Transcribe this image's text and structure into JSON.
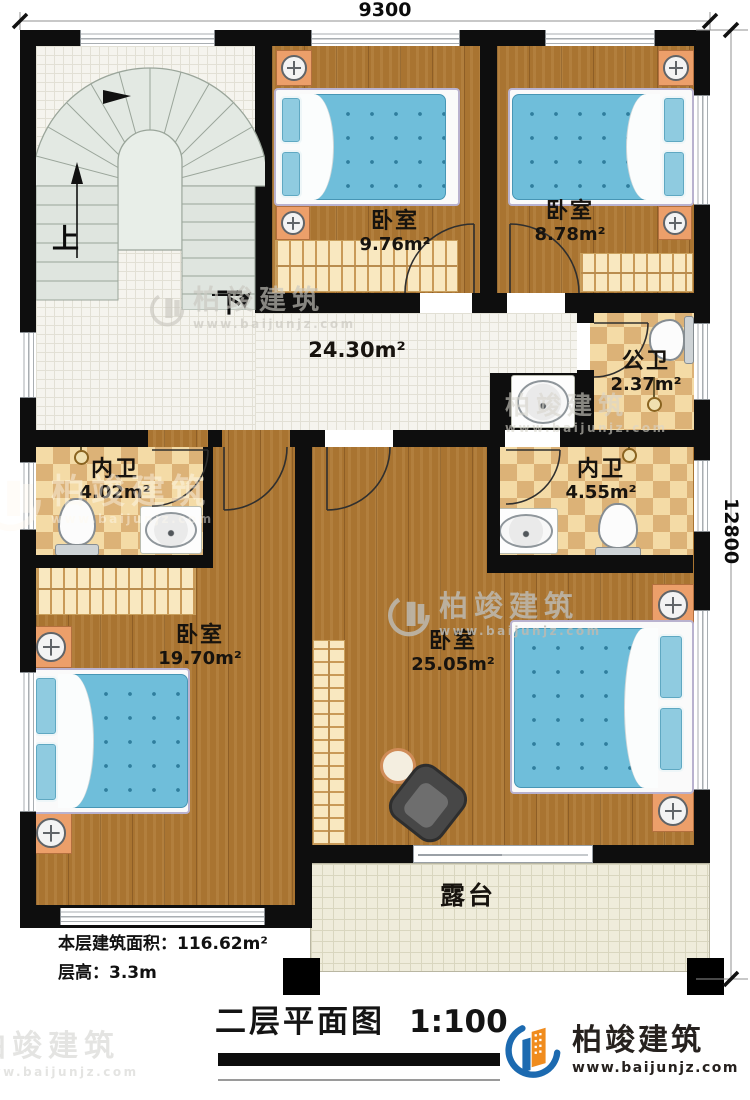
{
  "dimensions": {
    "top": "9300",
    "right": "12800"
  },
  "stairs": {
    "up": "上",
    "down": "下"
  },
  "rooms": {
    "bedroom1": {
      "name": "卧室",
      "area": "9.76m²"
    },
    "bedroom2": {
      "name": "卧室",
      "area": "8.78m²"
    },
    "hall": {
      "area": "24.30m²"
    },
    "public_bath": {
      "name": "公卫",
      "area": "2.37m²"
    },
    "ensuite_left": {
      "name": "内卫",
      "area": "4.02m²"
    },
    "ensuite_right": {
      "name": "内卫",
      "area": "4.55m²"
    },
    "bedroom3": {
      "name": "卧室",
      "area": "19.70m²"
    },
    "bedroom4": {
      "name": "卧室",
      "area": "25.05m²"
    },
    "terrace": {
      "name": "露台"
    }
  },
  "stats": {
    "floor_area": "本层建筑面积：116.62m²",
    "floor_height": "层高：3.3m"
  },
  "title": {
    "text": "二层平面图",
    "scale": "1:100"
  },
  "brand": {
    "name": "柏竣建筑",
    "url": "www.baijunjz.com"
  },
  "colors": {
    "accent_blue": "#1c6ab0",
    "accent_orange": "#f08c1e",
    "wall": "#0e0e0e"
  }
}
